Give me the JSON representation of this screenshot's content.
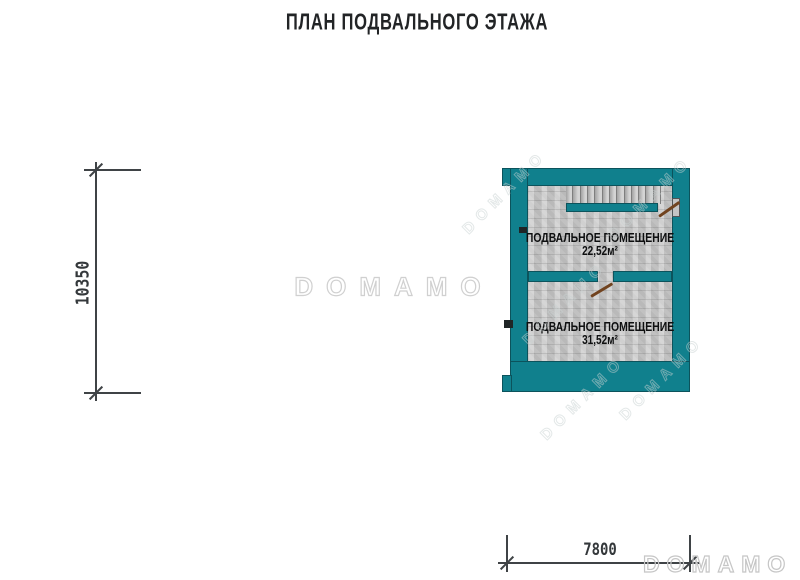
{
  "title": "ПЛАН ПОДВАЛЬНОГО ЭТАЖА",
  "watermark": {
    "text": "DOMAMO"
  },
  "dimensions": {
    "height_label": "10350",
    "width_label": "7800"
  },
  "plan": {
    "rooms": [
      {
        "label": "ПОДВАЛЬНОЕ ПОМЕЩЕНИЕ",
        "area": "22,52м²"
      },
      {
        "label": "ПОДВАЛЬНОЕ ПОМЕЩЕНИЕ",
        "area": "31,52м²"
      }
    ],
    "stairs": {
      "treads": 13
    },
    "colors": {
      "wall": "#10808d",
      "floor": "#c9c9c9",
      "door": "#71431f",
      "dimension": "#3f4346",
      "watermark": "#d0d0d0"
    }
  }
}
